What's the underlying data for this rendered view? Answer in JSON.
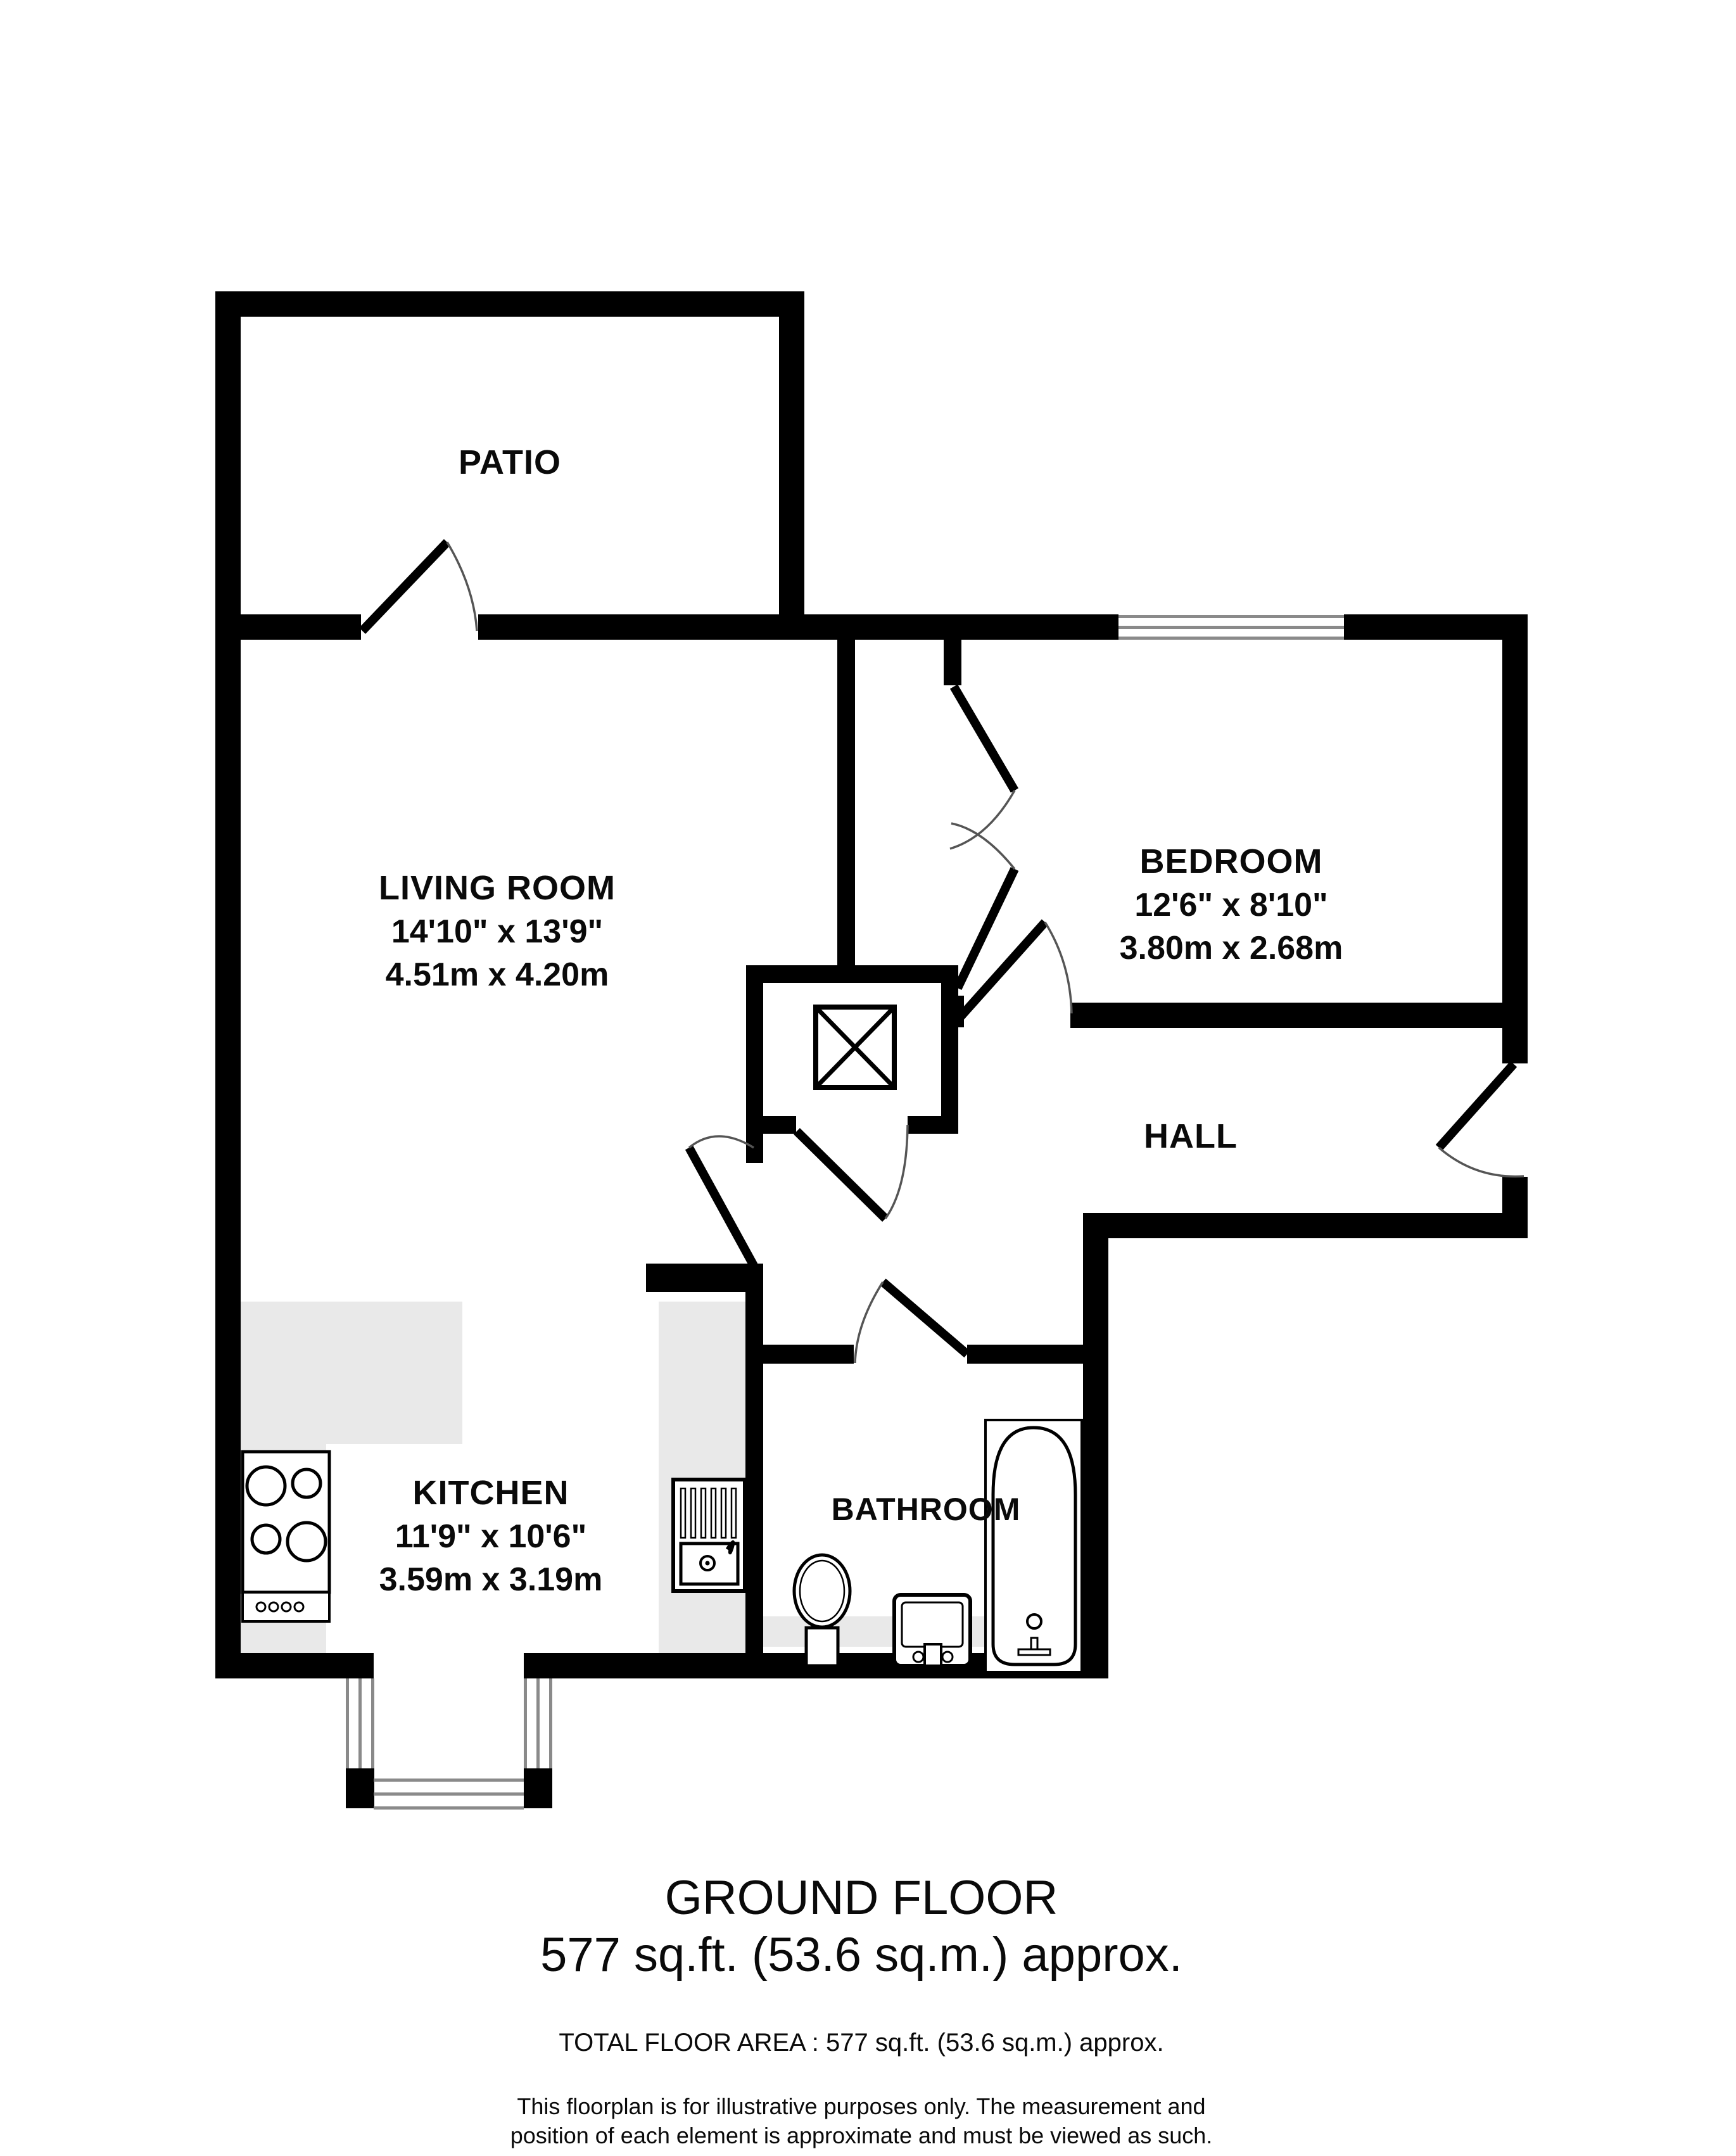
{
  "colors": {
    "wall": "#000000",
    "counter": "#e9e9e9",
    "window_line": "#8a8a8a",
    "door_arc": "#555555",
    "text": "#0a0a0a"
  },
  "rooms": {
    "patio": {
      "name": "PATIO"
    },
    "living_room": {
      "name": "LIVING ROOM",
      "size_imperial": "14'10\"  x 13'9\"",
      "size_metric": "4.51m  x 4.20m"
    },
    "bedroom": {
      "name": "BEDROOM",
      "size_imperial": "12'6\"  x 8'10\"",
      "size_metric": "3.80m  x 2.68m"
    },
    "hall": {
      "name": "HALL"
    },
    "kitchen": {
      "name": "KITCHEN",
      "size_imperial": "11'9\"  x 10'6\"",
      "size_metric": "3.59m  x 3.19m"
    },
    "bathroom": {
      "name": "BATHROOM"
    }
  },
  "fixtures": {
    "stove": "gas-hob-icon",
    "sink": "kitchen-sink-icon",
    "toilet": "toilet-icon",
    "basin": "hand-basin-icon",
    "bathtub": "bathtub-icon",
    "shaft": "crossed-box-shaft-icon"
  },
  "footer": {
    "floor_title": "GROUND FLOOR",
    "floor_area": "577 sq.ft. (53.6 sq.m.) approx.",
    "total_area": "TOTAL FLOOR AREA : 577 sq.ft. (53.6 sq.m.) approx.",
    "disclaimer_line1": "This floorplan is for illustrative purposes only. The measurement and",
    "disclaimer_line2": "position of each element is approximate and must be viewed as such."
  }
}
